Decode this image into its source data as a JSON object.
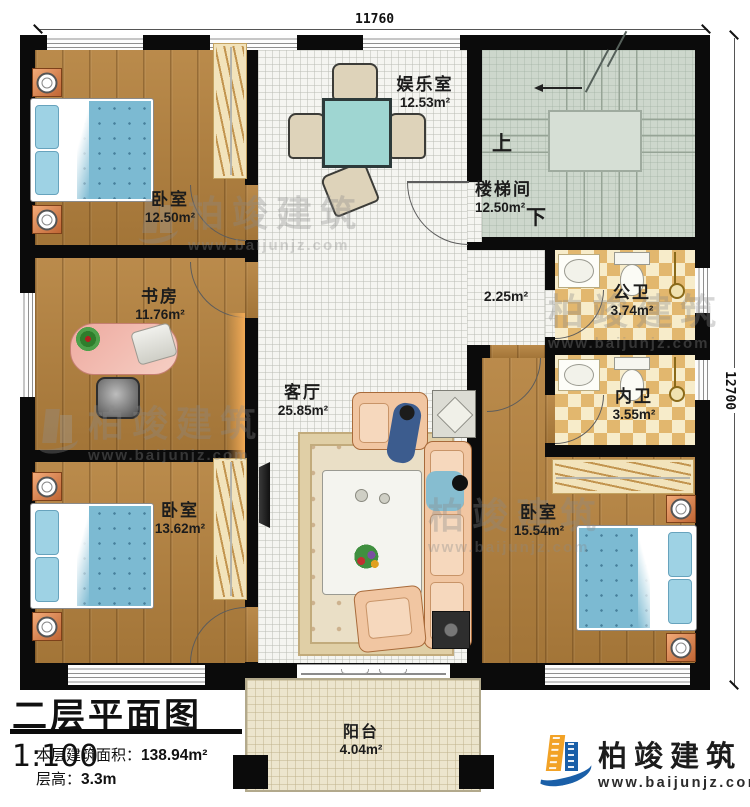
{
  "dimensions": {
    "top": "11760",
    "right": "12700"
  },
  "rooms": {
    "bedroom_tl": {
      "name": "卧室",
      "area": "12.50m²"
    },
    "study": {
      "name": "书房",
      "area": "11.76m²"
    },
    "bedroom_bl": {
      "name": "卧室",
      "area": "13.62m²"
    },
    "entertainment": {
      "name": "娱乐室",
      "area": "12.53m²"
    },
    "living": {
      "name": "客厅",
      "area": "25.85m²"
    },
    "stairwell": {
      "name": "楼梯间",
      "area": "12.50m²",
      "up": "上",
      "down": "下"
    },
    "corridor": {
      "area": "2.25m²"
    },
    "bath_public": {
      "name": "公卫",
      "area": "3.74m²"
    },
    "bath_private": {
      "name": "内卫",
      "area": "3.55m²"
    },
    "bedroom_br": {
      "name": "卧室",
      "area": "15.54m²"
    },
    "balcony": {
      "name": "阳台",
      "area": "4.04m²"
    }
  },
  "title_block": {
    "title": "二层平面图",
    "scale": "1:100",
    "area_label": "本层建筑面积：",
    "area_value": "138.94m²",
    "height_label": "层高：",
    "height_value": "3.3m"
  },
  "branding": {
    "company": "柏竣建筑",
    "website": "www.baijunjz.com"
  },
  "watermark": {
    "company": "柏竣建筑",
    "website": "www.baijunjz.com"
  },
  "colors": {
    "wall": "#0b0b0b",
    "wood_floor": "#b5823e",
    "hall_tile": "#f5f5f1",
    "stair_floor": "#cdd7cc",
    "bath_checker": "#e2b76e",
    "balcony_floor": "#ece5cd",
    "bed_blue": "#7cbad2",
    "logo_blue": "#1a5fa8",
    "logo_orange": "#f2a226"
  }
}
